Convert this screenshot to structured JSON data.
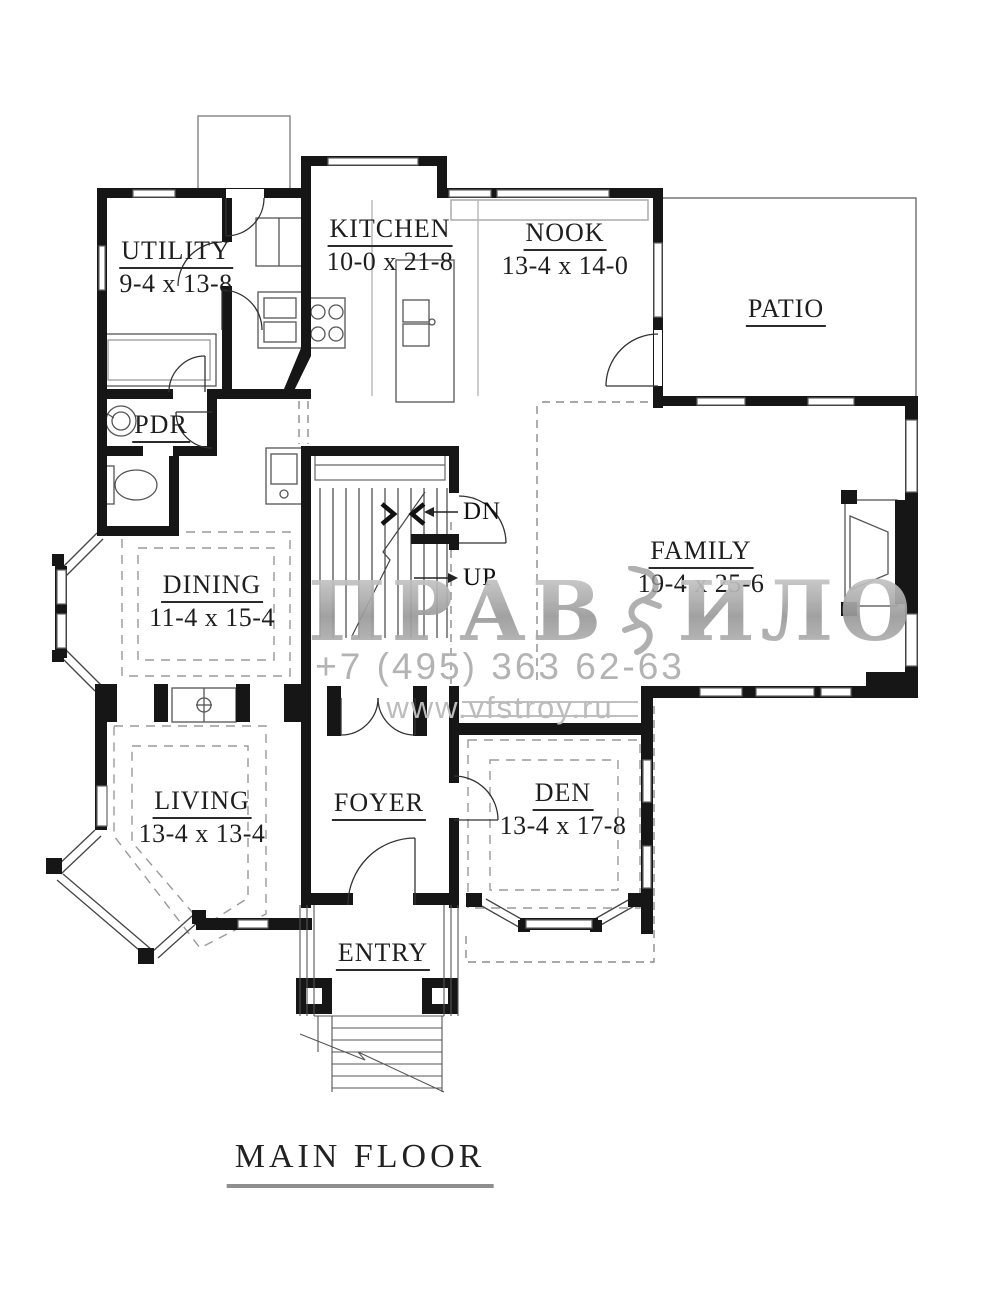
{
  "title": "MAIN FLOOR",
  "rooms": {
    "utility": {
      "name": "UTILITY",
      "dims": "9-4 x 13-8"
    },
    "kitchen": {
      "name": "KITCHEN",
      "dims": "10-0 x 21-8"
    },
    "nook": {
      "name": "NOOK",
      "dims": "13-4 x 14-0"
    },
    "patio": {
      "name": "PATIO"
    },
    "family": {
      "name": "FAMILY",
      "dims": "19-4 x 25-6"
    },
    "pdr": {
      "name": "PDR"
    },
    "dining": {
      "name": "DINING",
      "dims": "11-4 x 15-4"
    },
    "living": {
      "name": "LIVING",
      "dims": "13-4 x 13-4"
    },
    "foyer": {
      "name": "FOYER"
    },
    "den": {
      "name": "DEN",
      "dims": "13-4 x 17-8"
    },
    "entry": {
      "name": "ENTRY"
    }
  },
  "stairs": {
    "down_label": "DN",
    "up_label": "UP"
  },
  "watermark": {
    "brand_left": "ПРАВ",
    "brand_right": "ИЛО",
    "phone": "+7 (495) 363 62-63",
    "website": "www.vfstroy.ru"
  },
  "colors": {
    "wall": "#161616",
    "thin_line": "#555555",
    "dashed_line": "#999999",
    "watermark_text": "#b3b3b3"
  }
}
